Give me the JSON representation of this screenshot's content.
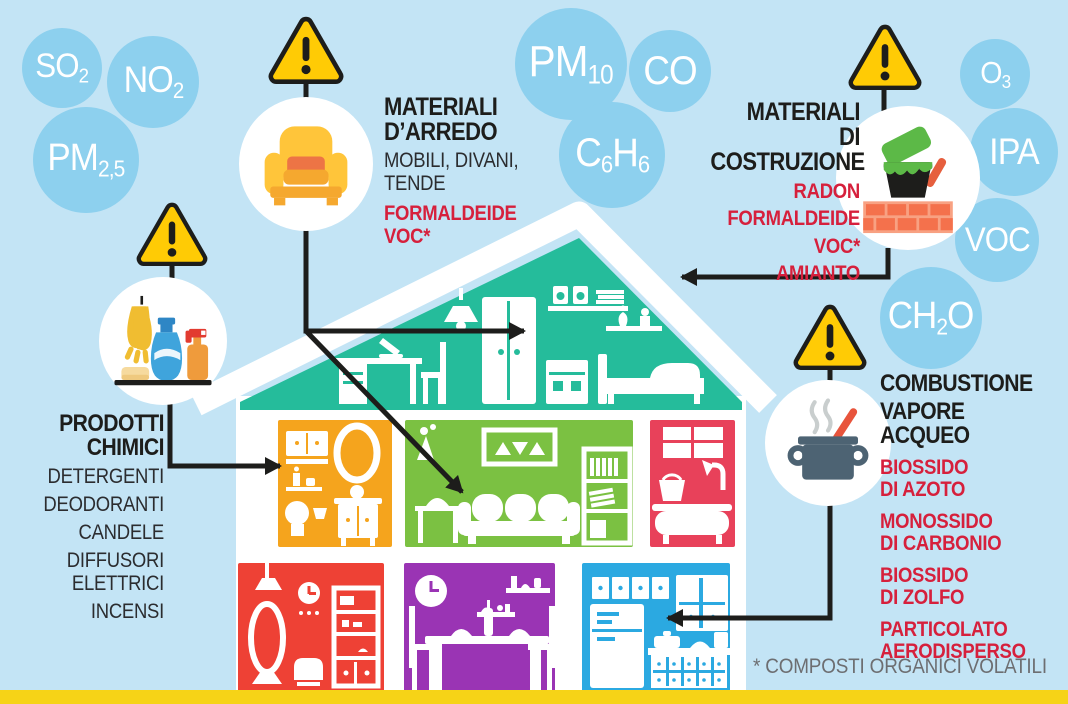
{
  "bubbles": [
    {
      "name": "so2",
      "label": "SO2",
      "parts": [
        {
          "text": "SO",
          "sub": false
        },
        {
          "text": "2",
          "sub": true
        }
      ]
    },
    {
      "name": "no2",
      "label": "NO2",
      "parts": [
        {
          "text": "NO",
          "sub": false
        },
        {
          "text": "2",
          "sub": true
        }
      ]
    },
    {
      "name": "pm2_5",
      "label": "PM2,5",
      "parts": [
        {
          "text": "PM",
          "sub": false
        },
        {
          "text": "2,5",
          "sub": true
        }
      ]
    },
    {
      "name": "pm10",
      "label": "PM10",
      "parts": [
        {
          "text": "PM",
          "sub": false
        },
        {
          "text": "10",
          "sub": true
        }
      ]
    },
    {
      "name": "co",
      "label": "CO",
      "parts": [
        {
          "text": "CO",
          "sub": false
        }
      ]
    },
    {
      "name": "c6h6",
      "label": "C6H6",
      "parts": [
        {
          "text": "C",
          "sub": false
        },
        {
          "text": "6",
          "sub": true
        },
        {
          "text": "H",
          "sub": false
        },
        {
          "text": "6",
          "sub": true
        }
      ]
    },
    {
      "name": "o3",
      "label": "O3",
      "parts": [
        {
          "text": "O",
          "sub": false
        },
        {
          "text": "3",
          "sub": true
        }
      ]
    },
    {
      "name": "ipa",
      "label": "IPA",
      "parts": [
        {
          "text": "IPA",
          "sub": false
        }
      ]
    },
    {
      "name": "voc",
      "label": "VOC",
      "parts": [
        {
          "text": "VOC",
          "sub": false
        }
      ]
    },
    {
      "name": "ch2o",
      "label": "CH2O",
      "parts": [
        {
          "text": "CH",
          "sub": false
        },
        {
          "text": "2",
          "sub": true
        },
        {
          "text": "O",
          "sub": false
        }
      ]
    }
  ],
  "sections": {
    "arredo": {
      "icon": "armchair-icon",
      "title_lines": [
        "MATERIALI",
        "D’ARREDO"
      ],
      "source_lines": [
        "MOBILI, DIVANI,",
        "TENDE"
      ],
      "pollutant_lines": [
        "FORMALDEIDE",
        "VOC*"
      ]
    },
    "costruzione": {
      "icon": "paint-bricks-icon",
      "title_lines": [
        "MATERIALI",
        "DI COSTRUZIONE"
      ],
      "pollutant_lines": [
        "RADON",
        "FORMALDEIDE",
        "VOC*",
        "AMIANTO"
      ]
    },
    "chimici": {
      "icon": "cleaning-products-icon",
      "title_lines": [
        "PRODOTTI",
        "CHIMICI"
      ],
      "source_items": [
        [
          "DETERGENTI"
        ],
        [
          "DEODORANTI"
        ],
        [
          "CANDELE"
        ],
        [
          "DIFFUSORI",
          "ELETTRICI"
        ],
        [
          "INCENSI"
        ]
      ]
    },
    "combustione": {
      "icon": "cooking-pot-icon",
      "title_lines": [
        "COMBUSTIONE"
      ],
      "subtitle_lines": [
        "VAPORE",
        "ACQUEO"
      ],
      "pollutant_items": [
        [
          "BIOSSIDO",
          "DI AZOTO"
        ],
        [
          "MONOSSIDO",
          "DI CARBONIO"
        ],
        [
          "BIOSSIDO",
          "DI ZOLFO"
        ],
        [
          "PARTICOLATO",
          "AERODISPERSO"
        ]
      ]
    }
  },
  "footnote": "* COMPOSTI ORGANICI VOLATILI",
  "colors": {
    "background": "#C3E4F5",
    "bubble_blue": "#8DD0EE",
    "attic_teal": "#25BC9B",
    "room_orange": "#F5A41D",
    "room_green": "#7BC142",
    "room_red_bath": "#E8415A",
    "room_red": "#EE4135",
    "room_purple": "#9A34B4",
    "room_blue": "#2BA9E1",
    "warning_yellow": "#FFCB05",
    "pollutant_red_text": "#D6203C",
    "footer_strip_yellow": "#F6D317"
  }
}
